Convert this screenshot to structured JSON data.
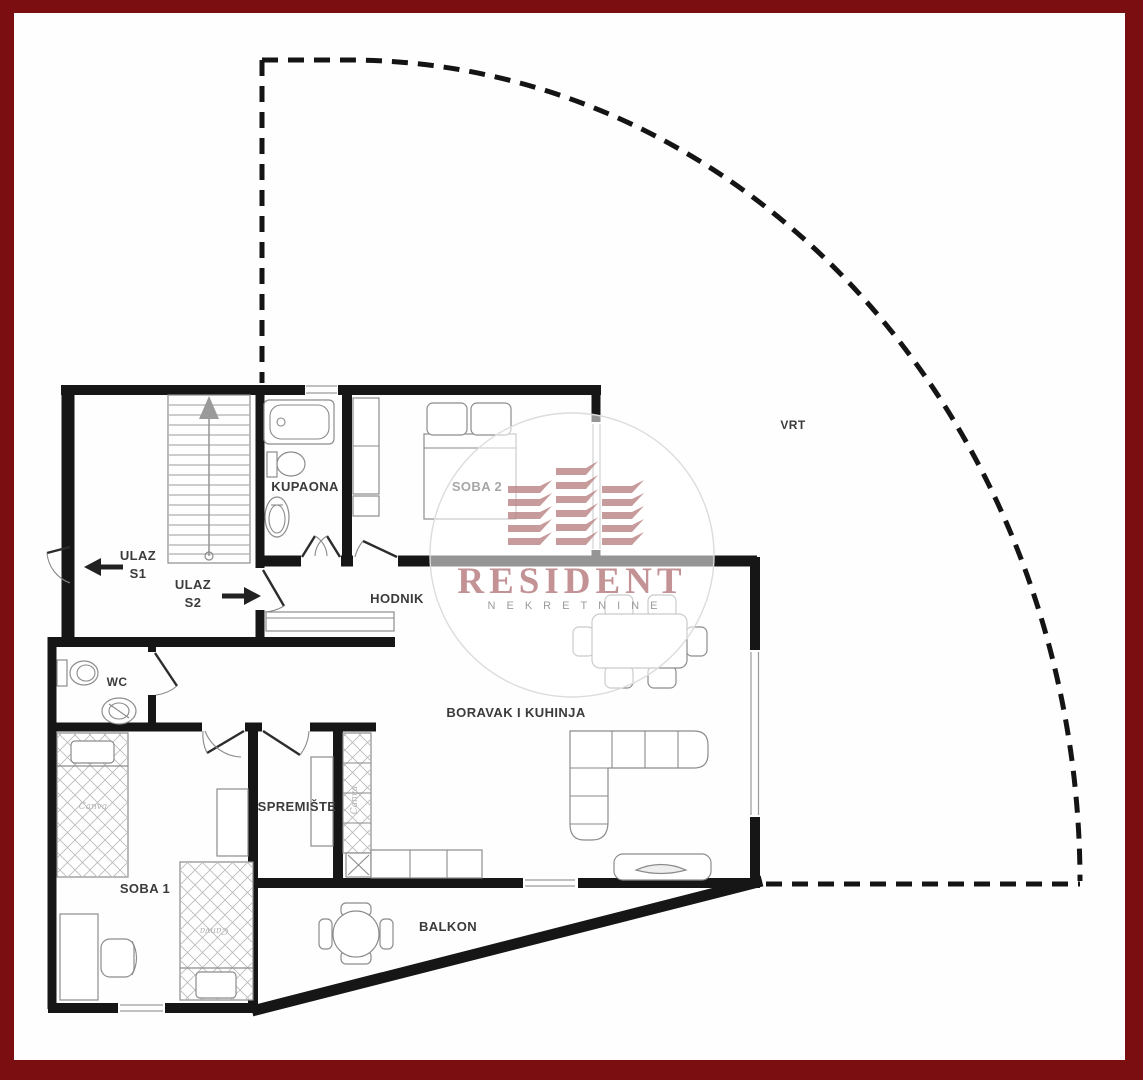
{
  "frame": {
    "color": "#7a0e10"
  },
  "plan": {
    "garden": {
      "label": "VRT"
    },
    "rooms": {
      "kupaona": {
        "label": "KUPAONA"
      },
      "soba2": {
        "label": "SOBA 2"
      },
      "hodnik": {
        "label": "HODNIK"
      },
      "wc": {
        "label": "WC"
      },
      "boravak": {
        "label": "BORAVAK I KUHINJA"
      },
      "spremiste": {
        "label": "SPREMIŠTE"
      },
      "soba1": {
        "label": "SOBA 1"
      },
      "balkon": {
        "label": "BALKON"
      }
    },
    "entrances": {
      "s1": {
        "label": "ULAZ",
        "number": "S1",
        "direction": "left"
      },
      "s2": {
        "label": "ULAZ",
        "number": "S2",
        "direction": "right"
      }
    }
  },
  "watermark": {
    "brand": "RESIDENT",
    "tagline": "NEKRETNINE"
  },
  "vendor_watermark": {
    "text": "Canva"
  },
  "colors": {
    "walls": "#161616",
    "furniture_outline": "#8c8c8c",
    "label_text": "#3b3b3b",
    "brand": "#ba8084",
    "frame": "#7a0e10"
  }
}
